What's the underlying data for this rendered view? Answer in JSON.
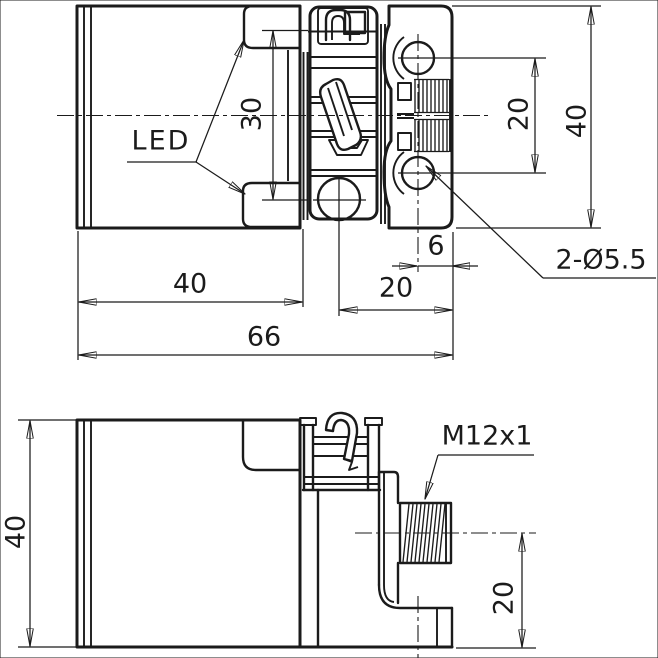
{
  "colors": {
    "ink": "#1b1b1b",
    "background": "#ffffff"
  },
  "top_view": {
    "led_label": "LED",
    "dim_led_spacing": "30",
    "dim_overall_height": "40",
    "dim_hole_spacing": "20",
    "dim_hole_to_edge": "6",
    "holes_label": "2-Ø5.5",
    "dim_clamp_to_edge": "20",
    "dim_body_width": "40",
    "dim_overall_length": "66"
  },
  "side_view": {
    "dim_height": "40",
    "connector_label": "M12x1",
    "dim_connector_height": "20"
  }
}
